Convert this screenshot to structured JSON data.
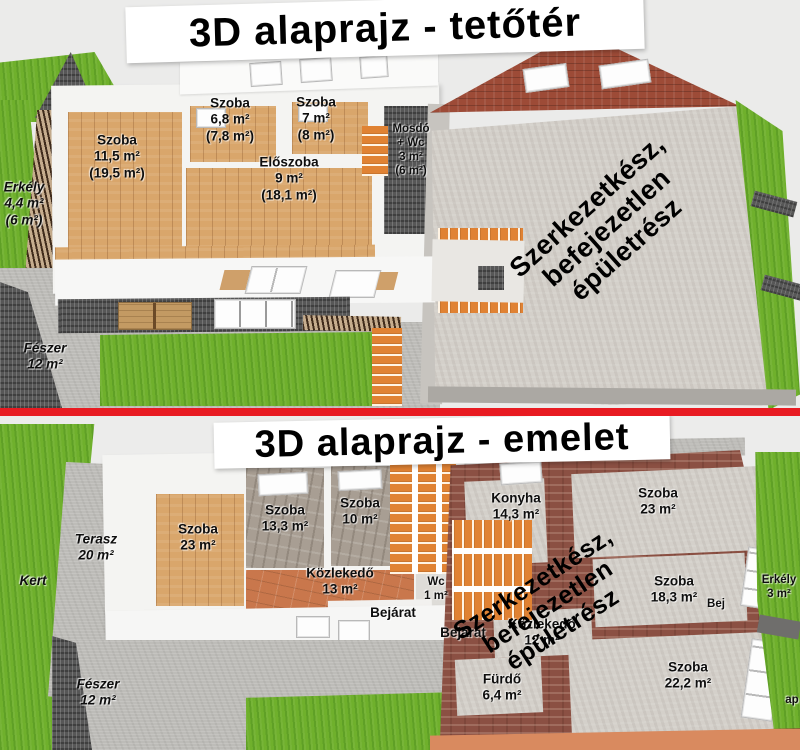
{
  "colors": {
    "divider_red": "#e81b22",
    "grass_green": "#6fb02c",
    "roof_brick": "#9d4b37",
    "brick_wall": "#8b5043",
    "wood_floor": "#d9a66b",
    "stairs_orange": "#e08233",
    "path_gray": "#bdbcb8",
    "concrete_gray": "#d4d0ca"
  },
  "attic": {
    "title": "3D alaprajz - tetőtér",
    "note": "Szerkezetkész,\nbefejezetlen épületrész",
    "labels": {
      "erkely": "Erkély\n4,4 m²\n(6 m²)",
      "szoba_nagy": "Szoba\n11,5 m²\n(19,5 m²)",
      "szoba_kis1": "Szoba\n6,8 m²\n(7,8 m²)",
      "szoba_kis2": "Szoba\n7 m²\n(8 m²)",
      "eloszoba": "Előszoba\n9 m²\n(18,1 m²)",
      "mosdo": "Mosdó\n+ Wc\n3 m²\n(6 m²)",
      "feszer": "Fészer\n12 m²"
    }
  },
  "emelet": {
    "title": "3D alaprajz - emelet",
    "note": "Szerkezetkész,\nbefejezetlen épületrész",
    "labels": {
      "kert": "Kert",
      "terasz": "Terasz\n20 m²",
      "szoba23_bal": "Szoba\n23 m²",
      "szoba133": "Szoba\n13,3 m²",
      "szoba10": "Szoba\n10 m²",
      "kozlekedo13": "Közlekedő\n13 m²",
      "wc": "Wc\n1 m²",
      "bejarat_1": "Bejárat",
      "bejarat_2": "Bejárat",
      "konyha": "Konyha\n14,3 m²",
      "szoba23_jobb": "Szoba\n23 m²",
      "szoba183": "Szoba\n18,3 m²",
      "bej_reszlet": "Bej",
      "erkely3": "Erkély\n3 m²",
      "kozlekedo12": "Közlekedő\n12 m²",
      "furdo": "Fürdő\n6,4 m²",
      "szoba222": "Szoba\n22,2 m²",
      "feszer": "Fészer\n12 m²",
      "ap_reszlet": "ap"
    }
  }
}
